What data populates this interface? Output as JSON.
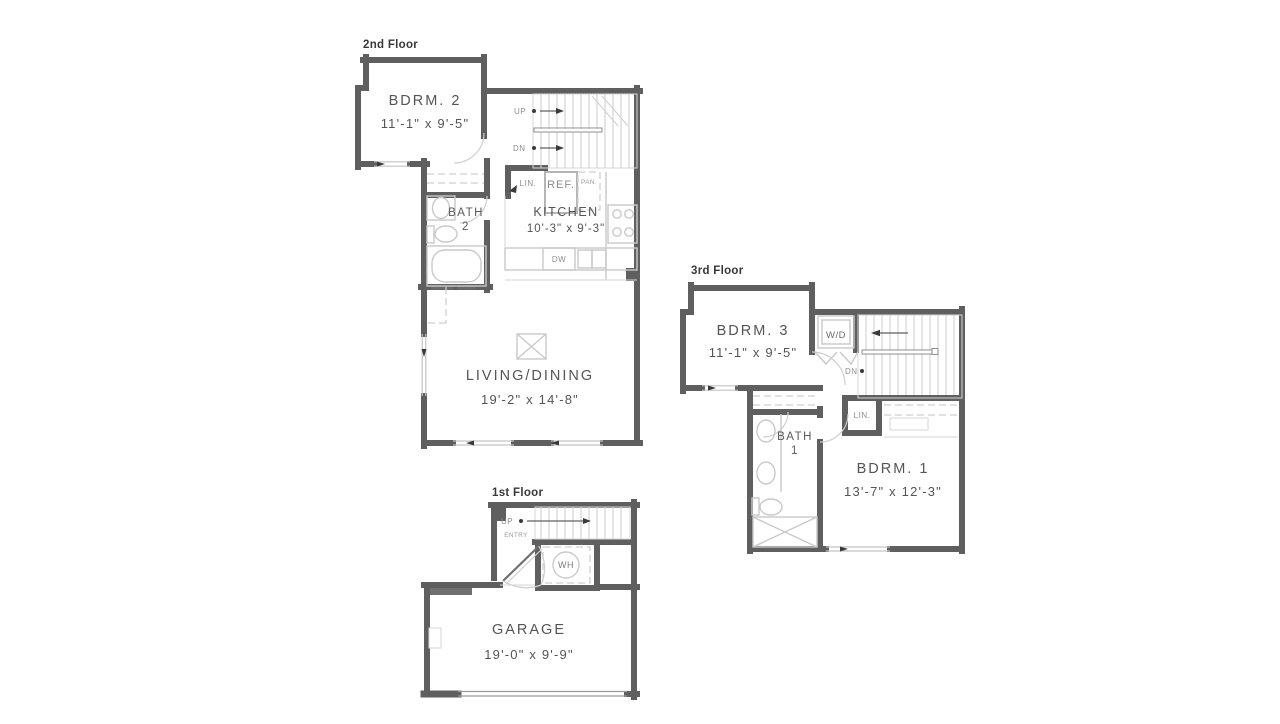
{
  "document_type": "residential floor plan",
  "colors": {
    "background": "#ffffff",
    "wall": "#5f5f5f",
    "fixture_line": "#c9c9c9",
    "room_label": "#545454",
    "small_label": "#8d8d8d",
    "title": "#383838"
  },
  "floors": {
    "second": {
      "title": "2nd Floor",
      "rooms": {
        "bdrm2": {
          "name": "BDRM. 2",
          "dims": "11'-1\" x 9'-5\""
        },
        "bath2": {
          "name": "BATH",
          "number": "2"
        },
        "kitchen": {
          "name": "KITCHEN",
          "dims": "10'-3\" x 9'-3\""
        },
        "living": {
          "name": "LIVING/DINING",
          "dims": "19'-2\" x 14'-8\""
        }
      },
      "labels": {
        "up": "UP",
        "dn": "DN",
        "lin": "LIN.",
        "ref": "REF.",
        "pan": "PAN.",
        "dw": "DW"
      }
    },
    "third": {
      "title": "3rd Floor",
      "rooms": {
        "bdrm3": {
          "name": "BDRM. 3",
          "dims": "11'-1\" x 9'-5\""
        },
        "bath1": {
          "name": "BATH",
          "number": "1"
        },
        "bdrm1": {
          "name": "BDRM. 1",
          "dims": "13'-7\" x 12'-3\""
        }
      },
      "labels": {
        "wd": "W/D",
        "dn": "DN",
        "lin": "LIN."
      }
    },
    "first": {
      "title": "1st Floor",
      "rooms": {
        "garage": {
          "name": "GARAGE",
          "dims": "19'-0\" x 9'-9\""
        }
      },
      "labels": {
        "up": "UP",
        "entry": "ENTRY",
        "wh": "WH"
      }
    }
  }
}
